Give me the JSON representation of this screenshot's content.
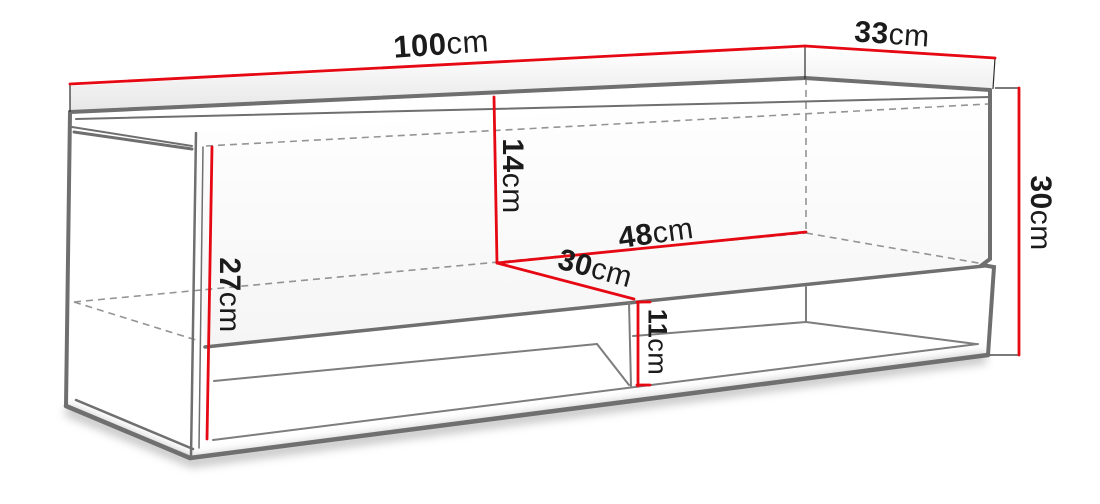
{
  "diagram": {
    "subject": "wall-mounted tv cabinet dimension drawing",
    "colors": {
      "dimension_line": "#e60812",
      "edge_line": "#6f6f6f",
      "hidden_edge_line": "#949494",
      "extension_line": "#2b2b2b",
      "label_text": "#1b1b1b",
      "background": "#ffffff"
    }
  },
  "dimensions": {
    "width_top": {
      "value": "100",
      "unit": "cm"
    },
    "depth_top": {
      "value": "33",
      "unit": "cm"
    },
    "height_right": {
      "value": "30",
      "unit": "cm"
    },
    "upper_interior_height": {
      "value": "14",
      "unit": "cm"
    },
    "right_section_width": {
      "value": "48",
      "unit": "cm"
    },
    "shelf_depth": {
      "value": "30",
      "unit": "cm"
    },
    "carcass_interior_height": {
      "value": "27",
      "unit": "cm"
    },
    "lower_opening_height": {
      "value": "11",
      "unit": "cm"
    }
  }
}
